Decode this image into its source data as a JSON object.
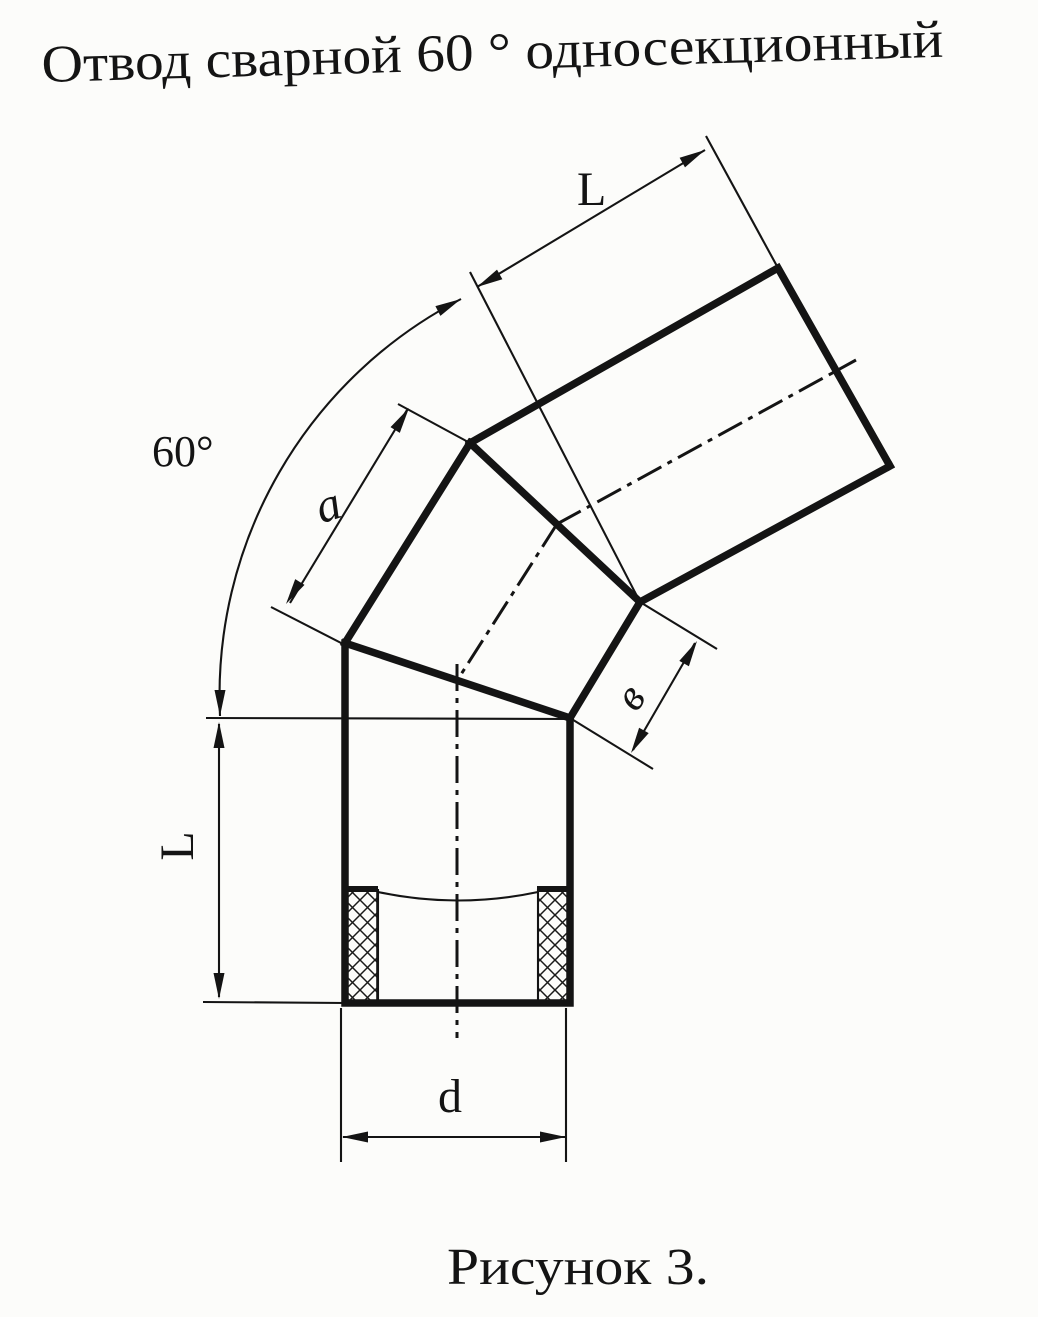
{
  "page": {
    "title": "Отвод сварной 60 ° односекционный",
    "caption": "Рисунок 3."
  },
  "dimensions": {
    "angle": "60°",
    "upper_segment_length": "L",
    "section_side_length": "a",
    "section_short_side": "в",
    "lower_segment_length": "L",
    "pipe_diameter": "d"
  },
  "colors": {
    "ink": "#141414",
    "paper": "#fcfcfa"
  }
}
